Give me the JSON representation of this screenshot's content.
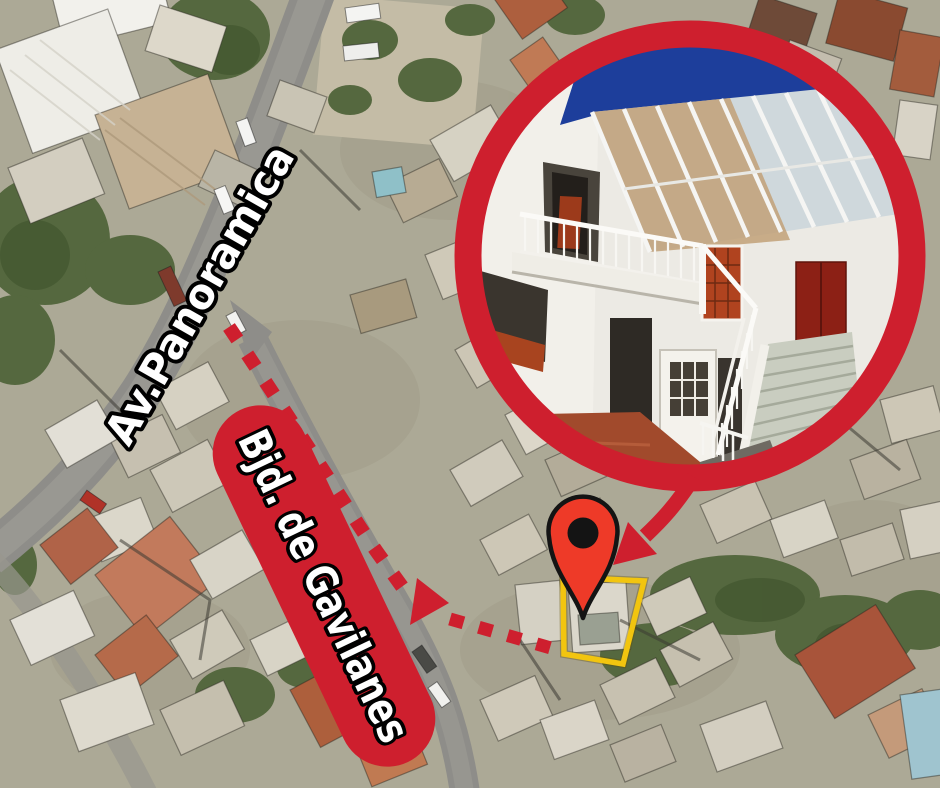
{
  "labels": {
    "av_panoramica": "Av.Panoramica",
    "bjd_gavilanes": "Bjd. de Gavilanes"
  },
  "icons": {
    "location_pin": "map-location-pin-icon",
    "route_arrow": "dashed-route-arrow-icon",
    "inset_pointer": "inset-callout-arrow-icon"
  },
  "colors": {
    "annotation_red": "#ce1f2e",
    "pin_red": "#ee3a28",
    "property_outline_yellow": "#f2c50f",
    "photo_sky_blue": "#1d3e9b"
  }
}
